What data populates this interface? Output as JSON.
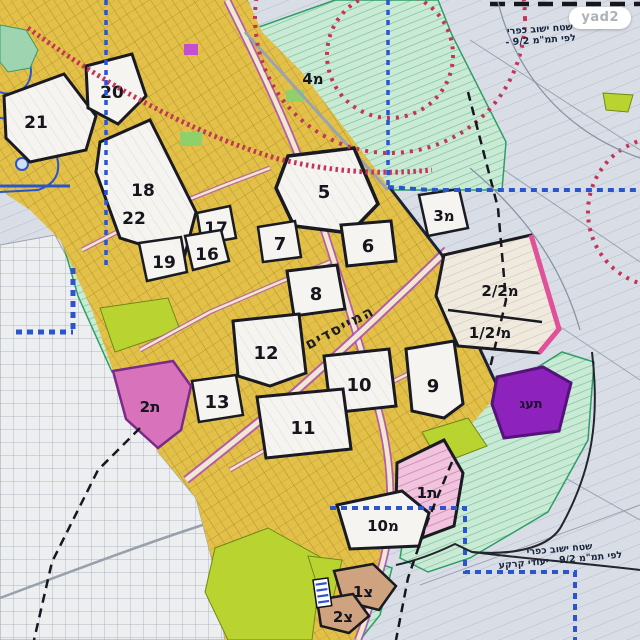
{
  "badge": {
    "label": "yad2"
  },
  "notes": {
    "top": {
      "line1": "שטח ישוב כפרי",
      "line2": "לפי תמ\"מ 9/2 -"
    },
    "bottom": {
      "line1": "שטח ישוב כפרי",
      "line2": "לפי תמ\"מ 9/2 - יעודי קרקע"
    }
  },
  "map": {
    "street_label": "המייסדים",
    "zones": [
      {
        "id": "21",
        "label": "21"
      },
      {
        "id": "20",
        "label": "20"
      },
      {
        "id": "18",
        "label": "18"
      },
      {
        "id": "22",
        "label": "22"
      },
      {
        "id": "17",
        "label": "17"
      },
      {
        "id": "19",
        "label": "19"
      },
      {
        "id": "16",
        "label": "16"
      },
      {
        "id": "5",
        "label": "5"
      },
      {
        "id": "7",
        "label": "7"
      },
      {
        "id": "6",
        "label": "6"
      },
      {
        "id": "8",
        "label": "8"
      },
      {
        "id": "12",
        "label": "12"
      },
      {
        "id": "4m",
        "label": "4מ"
      },
      {
        "id": "3m",
        "label": "3מ"
      },
      {
        "id": "2-2m",
        "label": "2/2מ"
      },
      {
        "id": "1-2m",
        "label": "1/2 מ"
      },
      {
        "id": "10",
        "label": "10"
      },
      {
        "id": "9",
        "label": "9"
      },
      {
        "id": "11",
        "label": "11"
      },
      {
        "id": "13",
        "label": "13"
      },
      {
        "id": "2t",
        "label": "2ת"
      },
      {
        "id": "taag",
        "label": "תעג"
      },
      {
        "id": "1t",
        "label": "1ת"
      },
      {
        "id": "10m",
        "label": "10מ"
      },
      {
        "id": "1tz",
        "label": "1צ"
      },
      {
        "id": "2tz",
        "label": "2צ"
      }
    ],
    "legend_colors": {
      "urban_yellow": "#e3c149",
      "rural_background": "#d9dee6",
      "agriculture_green": "#c9ead5",
      "intensive_green": "#b9d331",
      "zone_white": "#f5f4f0",
      "pink_zone": "#d873bb",
      "pink_hatch_zone": "#f0c4dc",
      "purple_zone": "#8e22bc",
      "tan_zone": "#cfa37f",
      "boundary_blue": "#2b55cc",
      "railway_red": "#c23558",
      "road_magenta": "#b04ab8"
    }
  }
}
